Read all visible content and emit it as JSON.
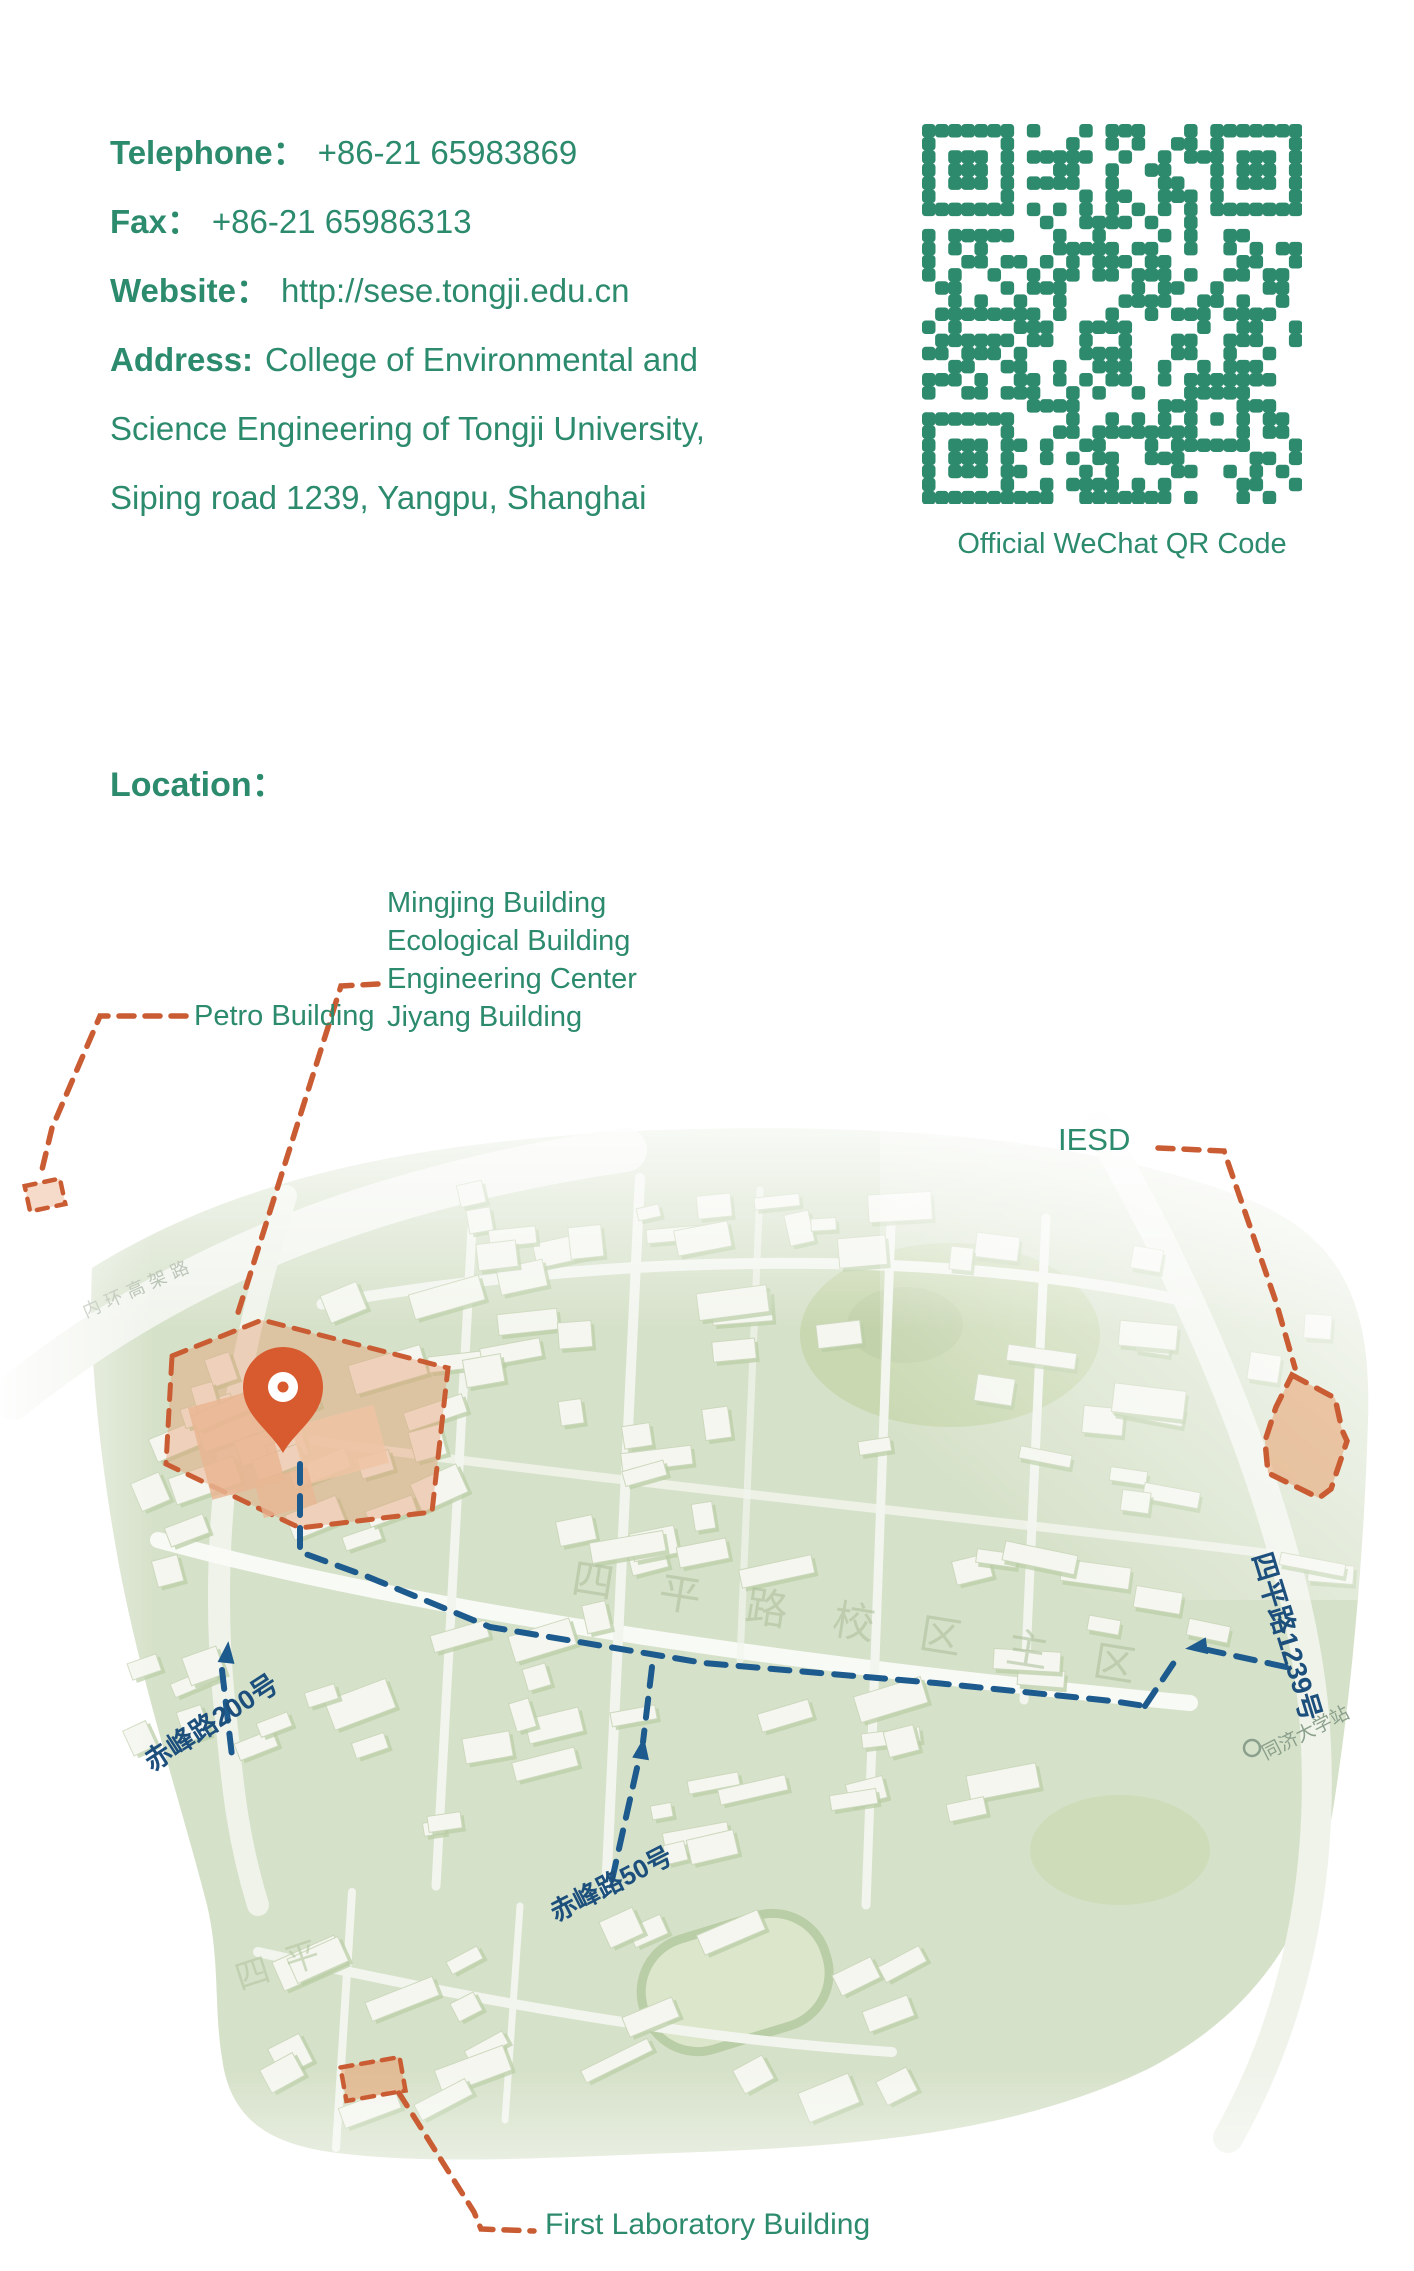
{
  "contact": {
    "telephone_label": "Telephone：",
    "telephone_value": "+86-21 65983869",
    "fax_label": "Fax：",
    "fax_value": "+86-21 65986313",
    "website_label": "Website：",
    "website_value": "http://sese.tongji.edu.cn",
    "address_label": "Address:",
    "address_line1": "College of Environmental and",
    "address_line2": "Science Engineering of Tongji University,",
    "address_line3": "Siping road 1239, Yangpu, Shanghai"
  },
  "qr": {
    "caption": "Official WeChat QR Code",
    "color": "#2e8a6c"
  },
  "location_heading": "Location：",
  "map": {
    "labels": {
      "petro": "Petro Building",
      "building_list": [
        "Mingjing Building",
        "Ecological Building",
        "Engineering Center",
        "Jiyang Building"
      ],
      "iesd": "IESD",
      "first_lab": "First Laboratory Building",
      "street_chifeng200": "赤峰路200号",
      "street_chifeng50": "赤峰路50号",
      "street_siping1239": "四平路1239号",
      "metro_station": "同济大学站",
      "highway": "内环高架路",
      "campus_watermark": "四平路校区主区",
      "annex_watermark": "四平"
    },
    "colors": {
      "accent_orange": "#c95c33",
      "salmon_fill": "#eab07f",
      "route_blue": "#1d5a8d",
      "street_label_navy": "#1d4f7d",
      "map_green": "#d6e1c9",
      "text_teal": "#2c8a6d"
    }
  }
}
